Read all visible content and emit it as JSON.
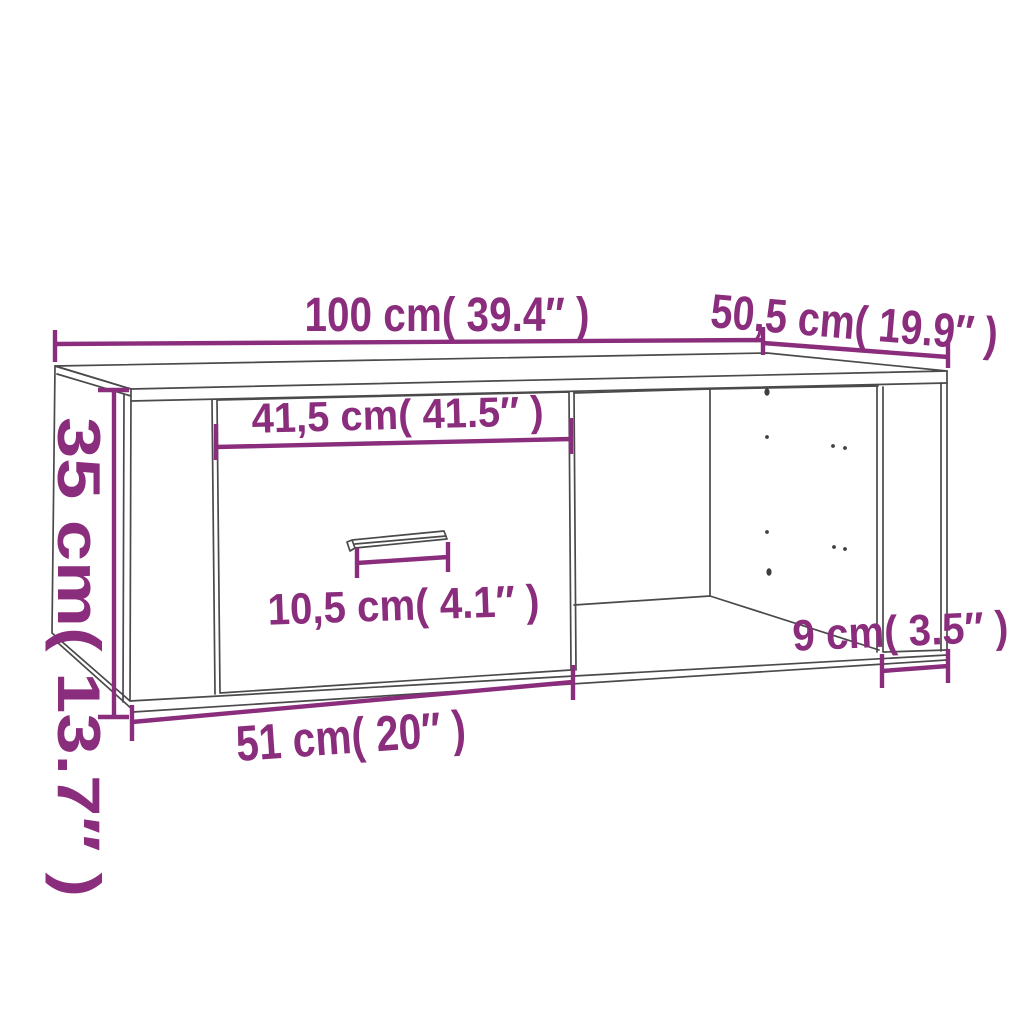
{
  "diagram": {
    "subject": "coffee table with drawer and open side compartment",
    "background_color": "#ffffff",
    "line_color": "#4a4a4a",
    "accent_color": "#8b2d7d",
    "dims": {
      "width": {
        "label": "100 cm( 39.4″ )",
        "cm": 100,
        "inch": 39.4
      },
      "depth": {
        "label": "50,5 cm( 19.9″ )",
        "cm": 50.5,
        "inch": 19.9
      },
      "height": {
        "label": "35 cm( 13.7″ )",
        "cm": 35,
        "inch": 13.7
      },
      "drawer_front": {
        "label": "41,5 cm( 41.5″ )",
        "cm": 41.5,
        "inch": 41.5
      },
      "handle": {
        "label": "10,5 cm( 4.1″ )",
        "cm": 10.5,
        "inch": 4.1
      },
      "side_opening": {
        "label": "9 cm( 3.5″ )",
        "cm": 9,
        "inch": 3.5
      },
      "bottom_front": {
        "label": "51 cm( 20″ )",
        "cm": 51,
        "inch": 20
      }
    }
  }
}
